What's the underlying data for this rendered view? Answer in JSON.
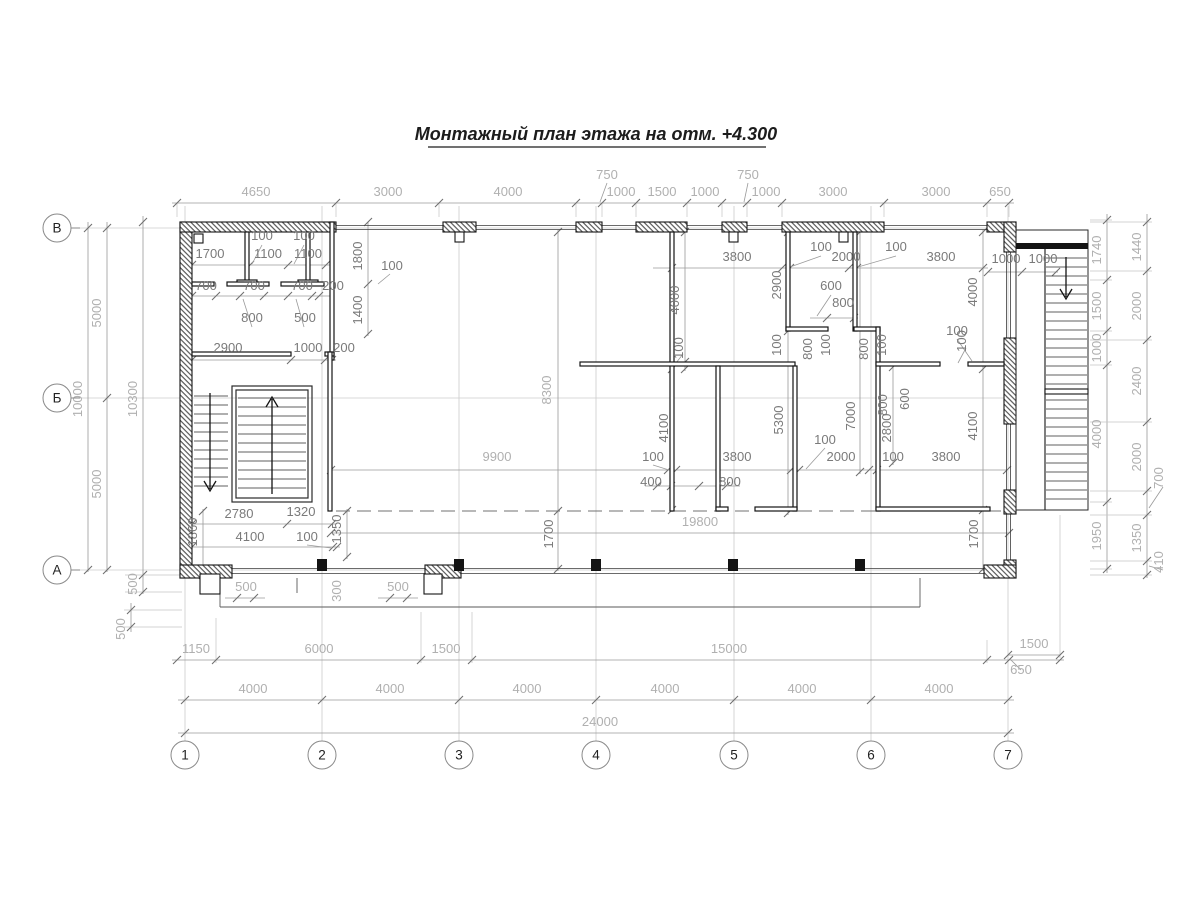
{
  "title": "Монтажный план этажа на отм. +4.300",
  "colors": {
    "wall": "#141414",
    "dimension_line": "#9a9a9a",
    "dimension_text_dark": "#7a7a7a",
    "dimension_text_light": "#b0b0b0",
    "grid_line": "#cccccc",
    "background": "#ffffff"
  },
  "axes": {
    "columns": [
      {
        "label": "1",
        "x": 185
      },
      {
        "label": "2",
        "x": 322
      },
      {
        "label": "3",
        "x": 459
      },
      {
        "label": "4",
        "x": 596
      },
      {
        "label": "5",
        "x": 734
      },
      {
        "label": "6",
        "x": 871
      },
      {
        "label": "7",
        "x": 1008
      }
    ],
    "columns_y": 755,
    "rows": [
      {
        "label": "В",
        "y": 228
      },
      {
        "label": "Б",
        "y": 398
      },
      {
        "label": "А",
        "y": 570
      }
    ],
    "rows_x": 57
  },
  "labels": [
    {
      "t": "4650",
      "x": 256,
      "y": 196
    },
    {
      "t": "3000",
      "x": 388,
      "y": 196
    },
    {
      "t": "4000",
      "x": 508,
      "y": 196
    },
    {
      "t": "750",
      "x": 607,
      "y": 179
    },
    {
      "t": "1000",
      "x": 621,
      "y": 196
    },
    {
      "t": "1500",
      "x": 662,
      "y": 196
    },
    {
      "t": "1000",
      "x": 705,
      "y": 196
    },
    {
      "t": "750",
      "x": 748,
      "y": 179
    },
    {
      "t": "1000",
      "x": 766,
      "y": 196
    },
    {
      "t": "3000",
      "x": 833,
      "y": 196
    },
    {
      "t": "3000",
      "x": 936,
      "y": 196
    },
    {
      "t": "650",
      "x": 1000,
      "y": 196
    },
    {
      "t": "5000",
      "x": 101,
      "y": 313,
      "r": 1
    },
    {
      "t": "5000",
      "x": 101,
      "y": 484,
      "r": 1
    },
    {
      "t": "10000",
      "x": 82,
      "y": 399,
      "r": 1
    },
    {
      "t": "10300",
      "x": 137,
      "y": 399,
      "r": 1
    },
    {
      "t": "500",
      "x": 137,
      "y": 584,
      "r": 1
    },
    {
      "t": "500",
      "x": 125,
      "y": 629,
      "r": 1
    },
    {
      "t": "1740",
      "x": 1101,
      "y": 250,
      "r": 1
    },
    {
      "t": "1500",
      "x": 1101,
      "y": 306,
      "r": 1
    },
    {
      "t": "1000",
      "x": 1101,
      "y": 348,
      "r": 1
    },
    {
      "t": "4000",
      "x": 1101,
      "y": 434,
      "r": 1
    },
    {
      "t": "1950",
      "x": 1101,
      "y": 536,
      "r": 1
    },
    {
      "t": "1440",
      "x": 1141,
      "y": 247,
      "r": 1
    },
    {
      "t": "2000",
      "x": 1141,
      "y": 306,
      "r": 1
    },
    {
      "t": "2400",
      "x": 1141,
      "y": 381,
      "r": 1
    },
    {
      "t": "2000",
      "x": 1141,
      "y": 457,
      "r": 1
    },
    {
      "t": "700",
      "x": 1163,
      "y": 478,
      "r": 1
    },
    {
      "t": "1350",
      "x": 1141,
      "y": 538,
      "r": 1
    },
    {
      "t": "410",
      "x": 1163,
      "y": 562,
      "r": 1
    },
    {
      "t": "1150",
      "x": 196,
      "y": 653
    },
    {
      "t": "6000",
      "x": 319,
      "y": 653
    },
    {
      "t": "1500",
      "x": 446,
      "y": 653
    },
    {
      "t": "15000",
      "x": 729,
      "y": 653
    },
    {
      "t": "1500",
      "x": 1034,
      "y": 648
    },
    {
      "t": "650",
      "x": 1021,
      "y": 674
    },
    {
      "t": "4000",
      "x": 253,
      "y": 693
    },
    {
      "t": "4000",
      "x": 390,
      "y": 693
    },
    {
      "t": "4000",
      "x": 527,
      "y": 693
    },
    {
      "t": "4000",
      "x": 665,
      "y": 693
    },
    {
      "t": "4000",
      "x": 802,
      "y": 693
    },
    {
      "t": "4000",
      "x": 939,
      "y": 693
    },
    {
      "t": "24000",
      "x": 600,
      "y": 726
    },
    {
      "t": "1700",
      "x": 210,
      "y": 258,
      "s": "d"
    },
    {
      "t": "100",
      "x": 262,
      "y": 240,
      "s": "d"
    },
    {
      "t": "1100",
      "x": 268,
      "y": 258,
      "s": "d"
    },
    {
      "t": "100",
      "x": 304,
      "y": 240,
      "s": "d"
    },
    {
      "t": "1100",
      "x": 308,
      "y": 258,
      "s": "d"
    },
    {
      "t": "1800",
      "x": 362,
      "y": 256,
      "r": 1,
      "s": "d"
    },
    {
      "t": "100",
      "x": 392,
      "y": 270,
      "s": "d"
    },
    {
      "t": "700",
      "x": 206,
      "y": 290,
      "s": "d"
    },
    {
      "t": "700",
      "x": 254,
      "y": 290,
      "s": "d"
    },
    {
      "t": "700",
      "x": 302,
      "y": 290,
      "s": "d"
    },
    {
      "t": "200",
      "x": 333,
      "y": 290,
      "s": "d"
    },
    {
      "t": "800",
      "x": 252,
      "y": 322,
      "s": "d"
    },
    {
      "t": "500",
      "x": 305,
      "y": 322,
      "s": "d"
    },
    {
      "t": "1400",
      "x": 362,
      "y": 310,
      "r": 1,
      "s": "d"
    },
    {
      "t": "2900",
      "x": 228,
      "y": 352,
      "s": "d"
    },
    {
      "t": "1000",
      "x": 308,
      "y": 352,
      "s": "d"
    },
    {
      "t": "200",
      "x": 344,
      "y": 352,
      "s": "d"
    },
    {
      "t": "2780",
      "x": 239,
      "y": 518,
      "s": "d"
    },
    {
      "t": "1320",
      "x": 301,
      "y": 516,
      "s": "d"
    },
    {
      "t": "1350",
      "x": 341,
      "y": 529,
      "r": 1,
      "s": "d"
    },
    {
      "t": "1860",
      "x": 197,
      "y": 532,
      "r": 1,
      "s": "d"
    },
    {
      "t": "4100",
      "x": 250,
      "y": 541,
      "s": "d"
    },
    {
      "t": "100",
      "x": 307,
      "y": 541,
      "s": "d"
    },
    {
      "t": "8300",
      "x": 551,
      "y": 390,
      "r": 1
    },
    {
      "t": "3800",
      "x": 737,
      "y": 261,
      "s": "d"
    },
    {
      "t": "100",
      "x": 821,
      "y": 251,
      "s": "d"
    },
    {
      "t": "2000",
      "x": 846,
      "y": 261,
      "s": "d"
    },
    {
      "t": "100",
      "x": 896,
      "y": 251,
      "s": "d"
    },
    {
      "t": "3800",
      "x": 941,
      "y": 261,
      "s": "d"
    },
    {
      "t": "2900",
      "x": 781,
      "y": 285,
      "r": 1,
      "s": "d"
    },
    {
      "t": "4000",
      "x": 679,
      "y": 300,
      "r": 1,
      "s": "d"
    },
    {
      "t": "4000",
      "x": 977,
      "y": 292,
      "r": 1,
      "s": "d"
    },
    {
      "t": "600",
      "x": 831,
      "y": 290,
      "s": "d"
    },
    {
      "t": "800",
      "x": 843,
      "y": 307,
      "s": "d"
    },
    {
      "t": "100",
      "x": 781,
      "y": 345,
      "r": 1,
      "s": "d"
    },
    {
      "t": "800",
      "x": 812,
      "y": 349,
      "r": 1,
      "s": "d"
    },
    {
      "t": "100",
      "x": 830,
      "y": 345,
      "r": 1,
      "s": "d"
    },
    {
      "t": "800",
      "x": 868,
      "y": 349,
      "r": 1,
      "s": "d"
    },
    {
      "t": "100",
      "x": 886,
      "y": 345,
      "r": 1,
      "s": "d"
    },
    {
      "t": "100",
      "x": 966,
      "y": 341,
      "r": 1,
      "s": "d"
    },
    {
      "t": "100",
      "x": 683,
      "y": 348,
      "r": 1,
      "s": "d"
    },
    {
      "t": "600",
      "x": 909,
      "y": 399,
      "r": 1,
      "s": "d"
    },
    {
      "t": "800",
      "x": 887,
      "y": 405,
      "r": 1,
      "s": "d"
    },
    {
      "t": "2800",
      "x": 891,
      "y": 428,
      "r": 1,
      "s": "d"
    },
    {
      "t": "7000",
      "x": 855,
      "y": 416,
      "r": 1,
      "s": "d"
    },
    {
      "t": "5300",
      "x": 783,
      "y": 420,
      "r": 1,
      "s": "d"
    },
    {
      "t": "4100",
      "x": 668,
      "y": 428,
      "r": 1,
      "s": "d"
    },
    {
      "t": "4100",
      "x": 977,
      "y": 426,
      "r": 1,
      "s": "d"
    },
    {
      "t": "9900",
      "x": 497,
      "y": 461
    },
    {
      "t": "100",
      "x": 653,
      "y": 461,
      "s": "d"
    },
    {
      "t": "3800",
      "x": 737,
      "y": 461,
      "s": "d"
    },
    {
      "t": "2000",
      "x": 841,
      "y": 461,
      "s": "d"
    },
    {
      "t": "100",
      "x": 893,
      "y": 461,
      "s": "d"
    },
    {
      "t": "3800",
      "x": 946,
      "y": 461,
      "s": "d"
    },
    {
      "t": "100",
      "x": 825,
      "y": 444,
      "s": "d"
    },
    {
      "t": "400",
      "x": 651,
      "y": 486,
      "s": "d"
    },
    {
      "t": "800",
      "x": 730,
      "y": 486,
      "s": "d"
    },
    {
      "t": "1700",
      "x": 553,
      "y": 534,
      "r": 1,
      "s": "d"
    },
    {
      "t": "1700",
      "x": 978,
      "y": 534,
      "r": 1,
      "s": "d"
    },
    {
      "t": "19800",
      "x": 700,
      "y": 526
    },
    {
      "t": "100",
      "x": 957,
      "y": 335,
      "s": "d"
    },
    {
      "t": "1000",
      "x": 1006,
      "y": 263,
      "s": "d"
    },
    {
      "t": "1000",
      "x": 1043,
      "y": 263,
      "s": "d"
    },
    {
      "t": "500",
      "x": 246,
      "y": 591
    },
    {
      "t": "300",
      "x": 341,
      "y": 591,
      "r": 1
    },
    {
      "t": "500",
      "x": 398,
      "y": 591
    }
  ]
}
